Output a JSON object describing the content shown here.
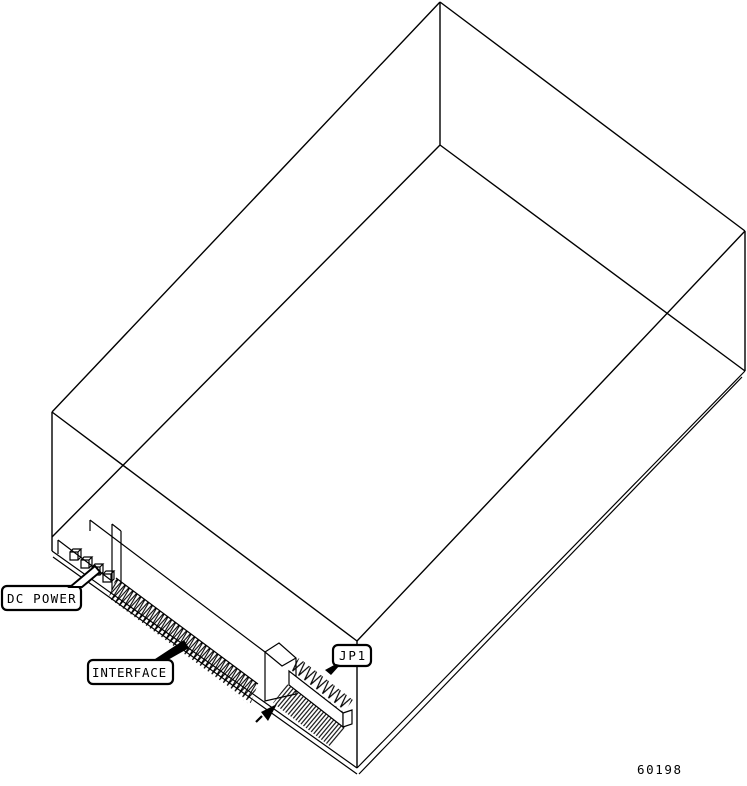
{
  "diagram": {
    "type": "isometric wireframe drive connector diagram",
    "labels": {
      "dc_power": "DC POWER",
      "interface": "INTERFACE",
      "jp1": "JP1"
    },
    "part_number": "60198",
    "colors": {
      "line": "#000000",
      "background": "#ffffff"
    },
    "icons": {
      "dc_power_pointer": "callout-tail-arrow",
      "interface_pointer": "callout-tail-arrow",
      "jp1_pointer": "callout-tail-arrow",
      "pin1_arrow": "pin-one-indicator-arrow"
    }
  }
}
